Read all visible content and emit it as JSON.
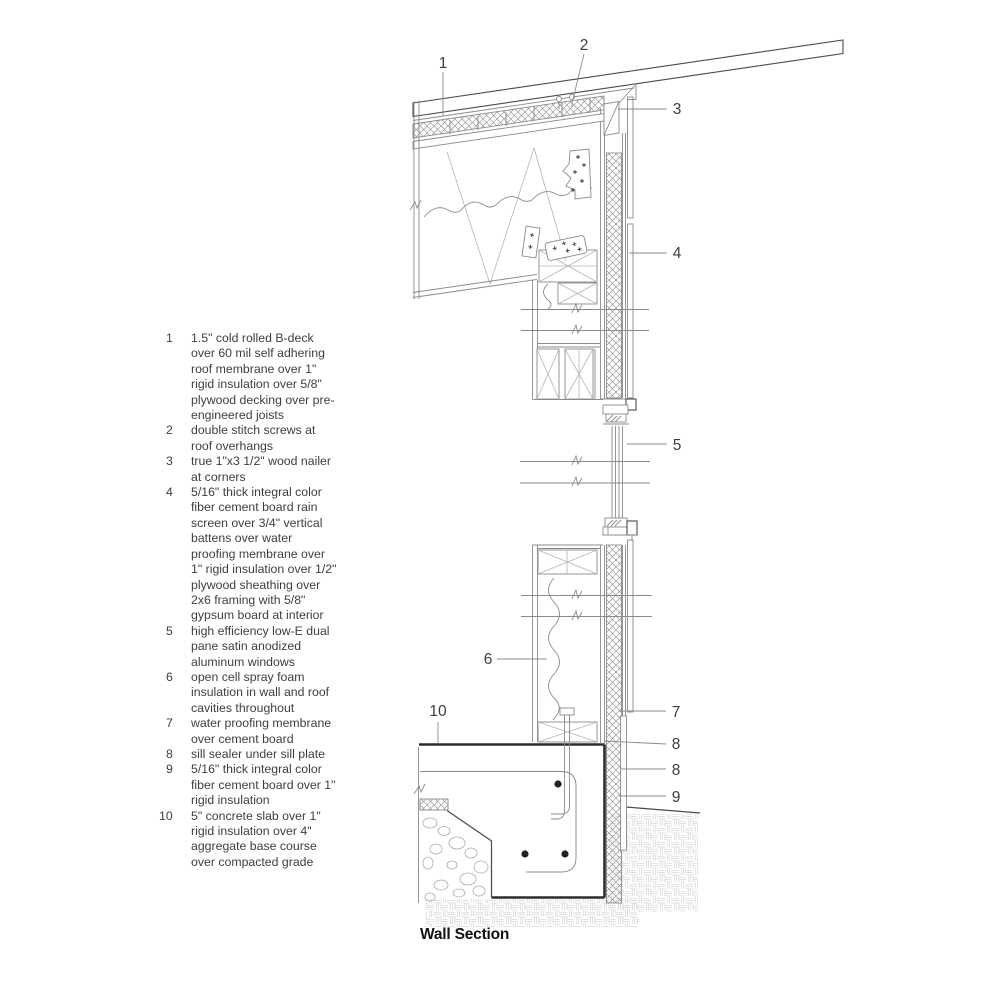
{
  "title": "Wall Section",
  "legend": {
    "items": [
      {
        "num": "1",
        "text": "1.5\" cold rolled B-deck over 60 mil self adhering roof membrane over 1\" rigid insulation over 5/8\" plywood decking over pre-engineered joists"
      },
      {
        "num": "2",
        "text": "double stitch screws at roof overhangs"
      },
      {
        "num": "3",
        "text": "true 1\"x3 1/2\" wood nailer at corners"
      },
      {
        "num": "4",
        "text": "5/16\" thick integral color fiber cement board rain screen over 3/4\" vertical battens over water proofing membrane over 1\" rigid insulation over 1/2\" plywood sheathing over 2x6 framing with 5/8\" gypsum board at interior"
      },
      {
        "num": "5",
        "text": "high efficiency low-E dual pane satin anodized aluminum windows"
      },
      {
        "num": "6",
        "text": "open cell spray foam insulation in wall and roof cavities throughout"
      },
      {
        "num": "7",
        "text": "water proofing membrane over cement board"
      },
      {
        "num": "8",
        "text": "sill sealer under sill plate"
      },
      {
        "num": "9",
        "text": "5/16\" thick integral color fiber cement board over 1\" rigid insulation"
      },
      {
        "num": "10",
        "text": "5\" concrete slab over 1\" rigid insulation over 4\" aggregate base course over compacted grade"
      }
    ]
  },
  "drawing": {
    "callouts": [
      {
        "label": "1"
      },
      {
        "label": "2"
      },
      {
        "label": "3"
      },
      {
        "label": "4"
      },
      {
        "label": "5"
      },
      {
        "label": "6"
      },
      {
        "label": "7"
      },
      {
        "label": "8"
      },
      {
        "label": "8"
      },
      {
        "label": "9"
      },
      {
        "label": "10"
      }
    ]
  },
  "colors": {
    "bg": "#ffffff",
    "line": "#8b8b8b",
    "line_dark": "#4a4a4a",
    "outline": "#2d2d2d",
    "hatch": "#9b9b9b",
    "aggregate": "#cccccc",
    "text": "#3e3e3e",
    "title": "#111111"
  }
}
